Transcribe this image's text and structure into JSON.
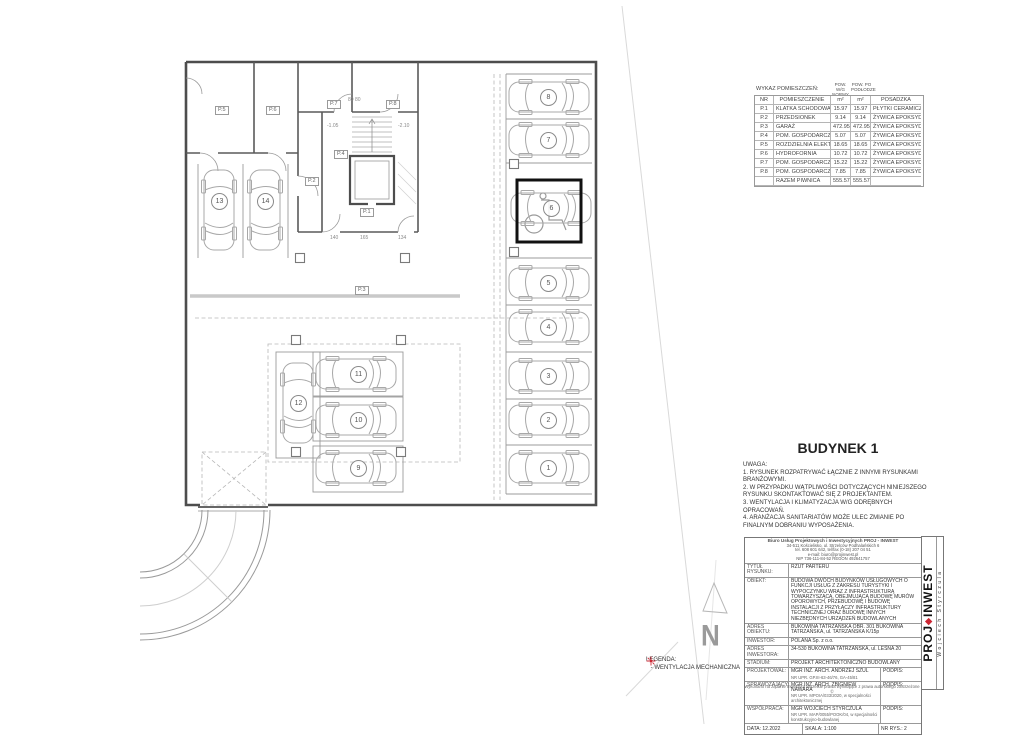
{
  "accent_red": "#cc2633",
  "room_table": {
    "title": "WYKAZ POMIESZCZEŃ:",
    "area_cols": [
      {
        "l1": "POW. W/G",
        "l2": "NORMY"
      },
      {
        "l1": "POW. PO",
        "l2": "PODŁODZE"
      }
    ],
    "columns": [
      "NR",
      "POMIESZCZENIE",
      "m²",
      "m²",
      "POSADZKA"
    ],
    "rows": [
      [
        "P.1",
        "KLATKA SCHODOWA",
        "15.97",
        "15.97",
        "PŁYTKI CERAMICZNE"
      ],
      [
        "P.2",
        "PRZEDSIONEK",
        "9.14",
        "9.14",
        "ŻYWICA EPOKSYDOWA"
      ],
      [
        "P.3",
        "GARAŻ",
        "472.95",
        "472.95",
        "ŻYWICA EPOKSYDOWA"
      ],
      [
        "P.4",
        "POM. GOSPODARCZE",
        "5.07",
        "5.07",
        "ŻYWICA EPOKSYDOWA"
      ],
      [
        "P.5",
        "ROZDZIELNIA ELEKTR.",
        "18.65",
        "18.65",
        "ŻYWICA EPOKSYDOWA"
      ],
      [
        "P.6",
        "HYDROFORNIA",
        "10.72",
        "10.72",
        "ŻYWICA EPOKSYDOWA"
      ],
      [
        "P.7",
        "POM. GOSPODARCZE",
        "15.22",
        "15.22",
        "ŻYWICA EPOKSYDOWA"
      ],
      [
        "P.8",
        "POM. GOSPODARCZE",
        "7.85",
        "7.85",
        "ŻYWICA EPOKSYDOWA"
      ]
    ],
    "total_row": [
      "",
      "RAZEM PIWNICA",
      "555.57",
      "555.57",
      ""
    ]
  },
  "plan": {
    "room_labels": {
      "p1": "P.1",
      "p2": "P.2",
      "p3": "P.3",
      "p4": "P.4",
      "p5": "P.5",
      "p6": "P.6",
      "p7": "P.7",
      "p8": "P.8"
    },
    "parking_numbers": [
      "1",
      "2",
      "3",
      "4",
      "5",
      "6",
      "7",
      "8",
      "9",
      "10",
      "11",
      "12",
      "13",
      "14"
    ],
    "dims": {
      "top": "80  80",
      "lvl_a": "-1.05",
      "lvl_b": "-2.10",
      "w1": "140",
      "w2": "165",
      "w3": "134"
    }
  },
  "north": {
    "label": "N"
  },
  "notes": {
    "building_title": "BUDYNEK 1",
    "uwaga_title": "UWAGA:",
    "items": [
      "1. RYSUNEK ROZPATRYWAĆ ŁĄCZNIE Z INNYMI RYSUNKAMI BRANŻOWYMI.",
      "2. W PRZYPADKU WĄTPLIWOŚCI DOTYCZĄCYCH NINIEJSZEGO RYSUNKU SKONTAKTOWAĆ SIĘ Z PROJEKTANTEM.",
      "3. WENTYLACJA I KLIMATYZACJA W/G ODRĘBNYCH OPRACOWAŃ.",
      "4. ARANŻACJA SANITARIATÓW MOŻE ULEC ZMIANIE PO FINALNYM DOBRANIU WYPOSAŻENIA."
    ]
  },
  "legend": {
    "title": "LEGENDA:",
    "item": "- WENTYLACJA MECHANICZNA"
  },
  "title_block": {
    "company_name": "Biuro Usług Projektowych i Inwestycyjnych PROJ - INWEST",
    "company_lines": [
      "34-511 Kościelisko, ul. Strzelców Podhalańskich 6",
      "tel. 608 601 642, tel/fax (0-18) 207 04 51",
      "e-mail: biuro@projinwest.pl",
      "NIP 736-111-84-52     REGON 492641757"
    ],
    "tytul_label": "TYTUŁ RYSUNKU:",
    "tytul": "RZUT PARTERU",
    "obiekt_label": "OBIEKT:",
    "obiekt": "BUDOWA DWÓCH BUDYNKÓW USŁUGOWYCH O FUNKCJI USŁUG Z ZAKRESU TURYSTYKI I WYPOCZYNKU WRAZ Z INFRASTRUKTURĄ TOWARZYSZĄCĄ, OBEJMUJĄCĄ BUDOWĘ MURÓW OPOROWYCH, PRZEBUDOWĘ I BUDOWĘ INSTALACJI Z PRZYŁĄCZY INFRASTRUKTURY TECHNICZNEJ ORAZ BUDOWĘ INNYCH NIEZBĘDNYCH URZĄDZEŃ BUDOWLANYCH",
    "adres_obiektu_label": "ADRES OBIEKTU:",
    "adres_obiektu": "BUKOWINA TATRZAŃSKA OBR. 301 BUKOWINA TATRZAŃSKA, ul. TATRZAŃSKA K/15p",
    "inwestor_label": "INWESTOR:",
    "inwestor": "POLANA Sp. z o.o.",
    "adres_inwestora_label": "ADRES INWESTORA:",
    "adres_inwestora": "34-530 BUKOWINA TATRZAŃSKA, ul. LEŚNA 20",
    "stadium_label": "STADIUM:",
    "stadium": "PROJEKT ARCHITEKTONICZNO BUDOWLANY",
    "people": [
      {
        "role": "PROJEKTOWAŁ:",
        "name": "MGR INŻ. ARCH. ANDRZEJ SZUL",
        "upr": "NR UPR. GP.III-63-46/76, GA-45/81",
        "podpis": "PODPIS:"
      },
      {
        "role": "SPRAWDZAJĄCY:",
        "name": "MGR INŻ. ARCH. ZBIGNIEW NAWARA",
        "upr": "NR UPR. MPOIA/033/2020, w specjalności architektonicznej",
        "podpis": "PODPIS:"
      },
      {
        "role": "WSPÓŁPRACA:",
        "name": "MGR WOJCIECH STYRCZULA",
        "upr": "NR UPR. MAP/0055/POOK/04, w specjalności konstrukcyjno-budowlanej",
        "podpis": "PODPIS:"
      }
    ],
    "data_label": "DATA:",
    "data": "12.2022",
    "skala_label": "SKALA:",
    "skala": "1:100",
    "nr_label": "NR RYS.:",
    "nr": "2",
    "footer": "Wykonano na żądanie Inwestora     Wszelkie prawa wynikające z prawa autorskiego zastrzeżone ©",
    "logo": {
      "part1": "PROJ",
      "diamond": "◆",
      "part2": "INWEST",
      "sub": "Wojciech Styrczula"
    }
  }
}
